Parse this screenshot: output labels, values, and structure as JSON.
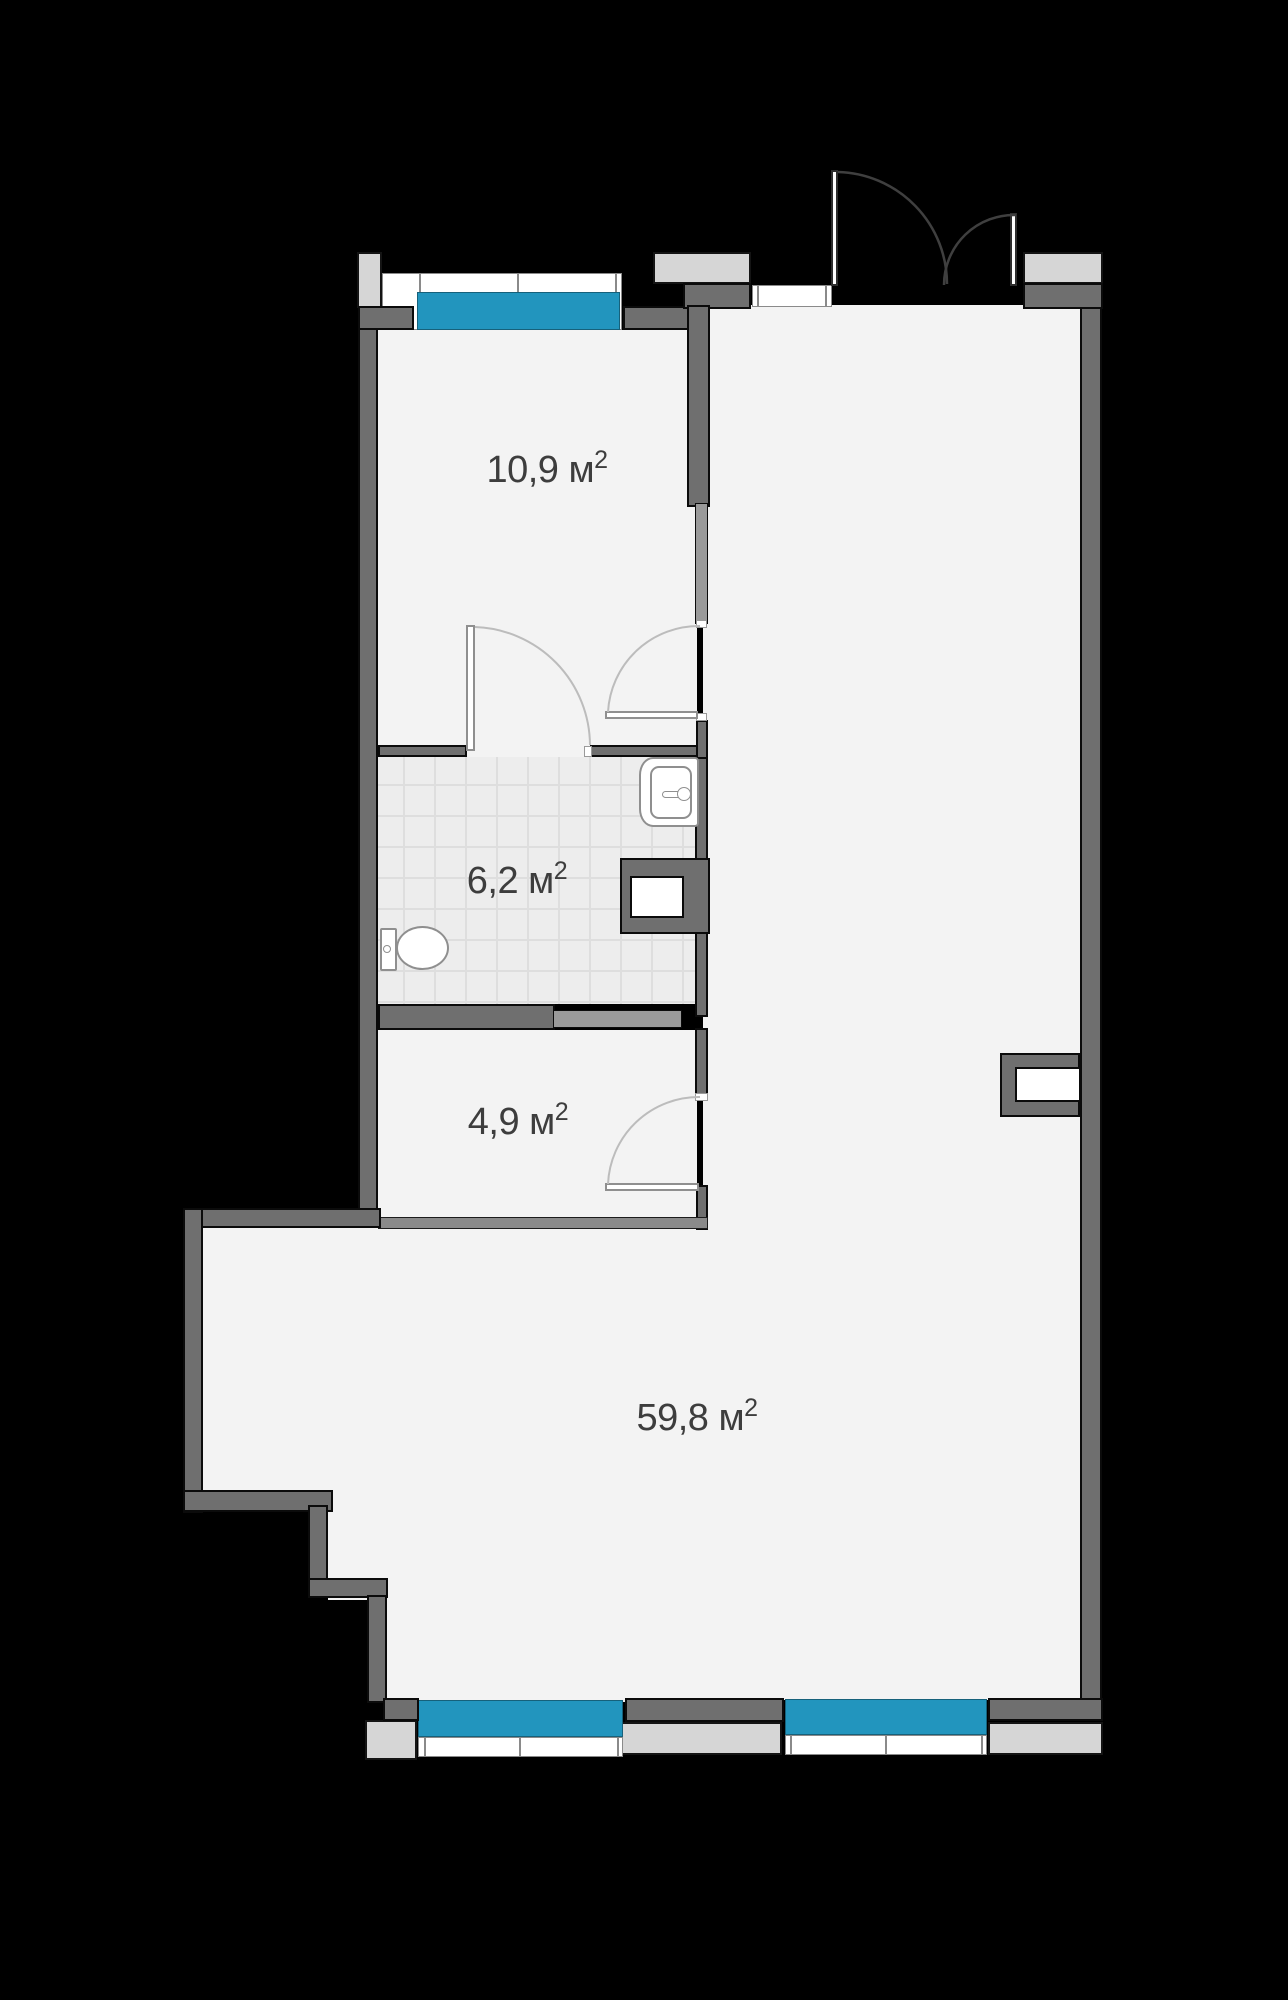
{
  "plan": {
    "title": "apartment-floor-plan",
    "rooms": [
      {
        "id": "room-top",
        "label": "10,9 м",
        "sup": "2"
      },
      {
        "id": "bathroom",
        "label": "6,2 м",
        "sup": "2"
      },
      {
        "id": "hallway",
        "label": "4,9 м",
        "sup": "2"
      },
      {
        "id": "living-room",
        "label": "59,8 м",
        "sup": "2"
      }
    ],
    "colors": {
      "background": "#000000",
      "floor": "#f3f3f3",
      "tile-floor": "#ededed",
      "tile-line": "#dedede",
      "wall": "#6f6f6f",
      "wall-light": "#9a9a9a",
      "partition": "#8a8a8a",
      "outline": "#0b0b0b",
      "slab": "#d6d6d6",
      "glass": "#2295be",
      "white": "#ffffff",
      "fixture-line": "#8f8f8f",
      "arc-light": "#bcbcbc",
      "arc-dark": "#3f3f3f",
      "text": "#3d3d3d"
    }
  }
}
